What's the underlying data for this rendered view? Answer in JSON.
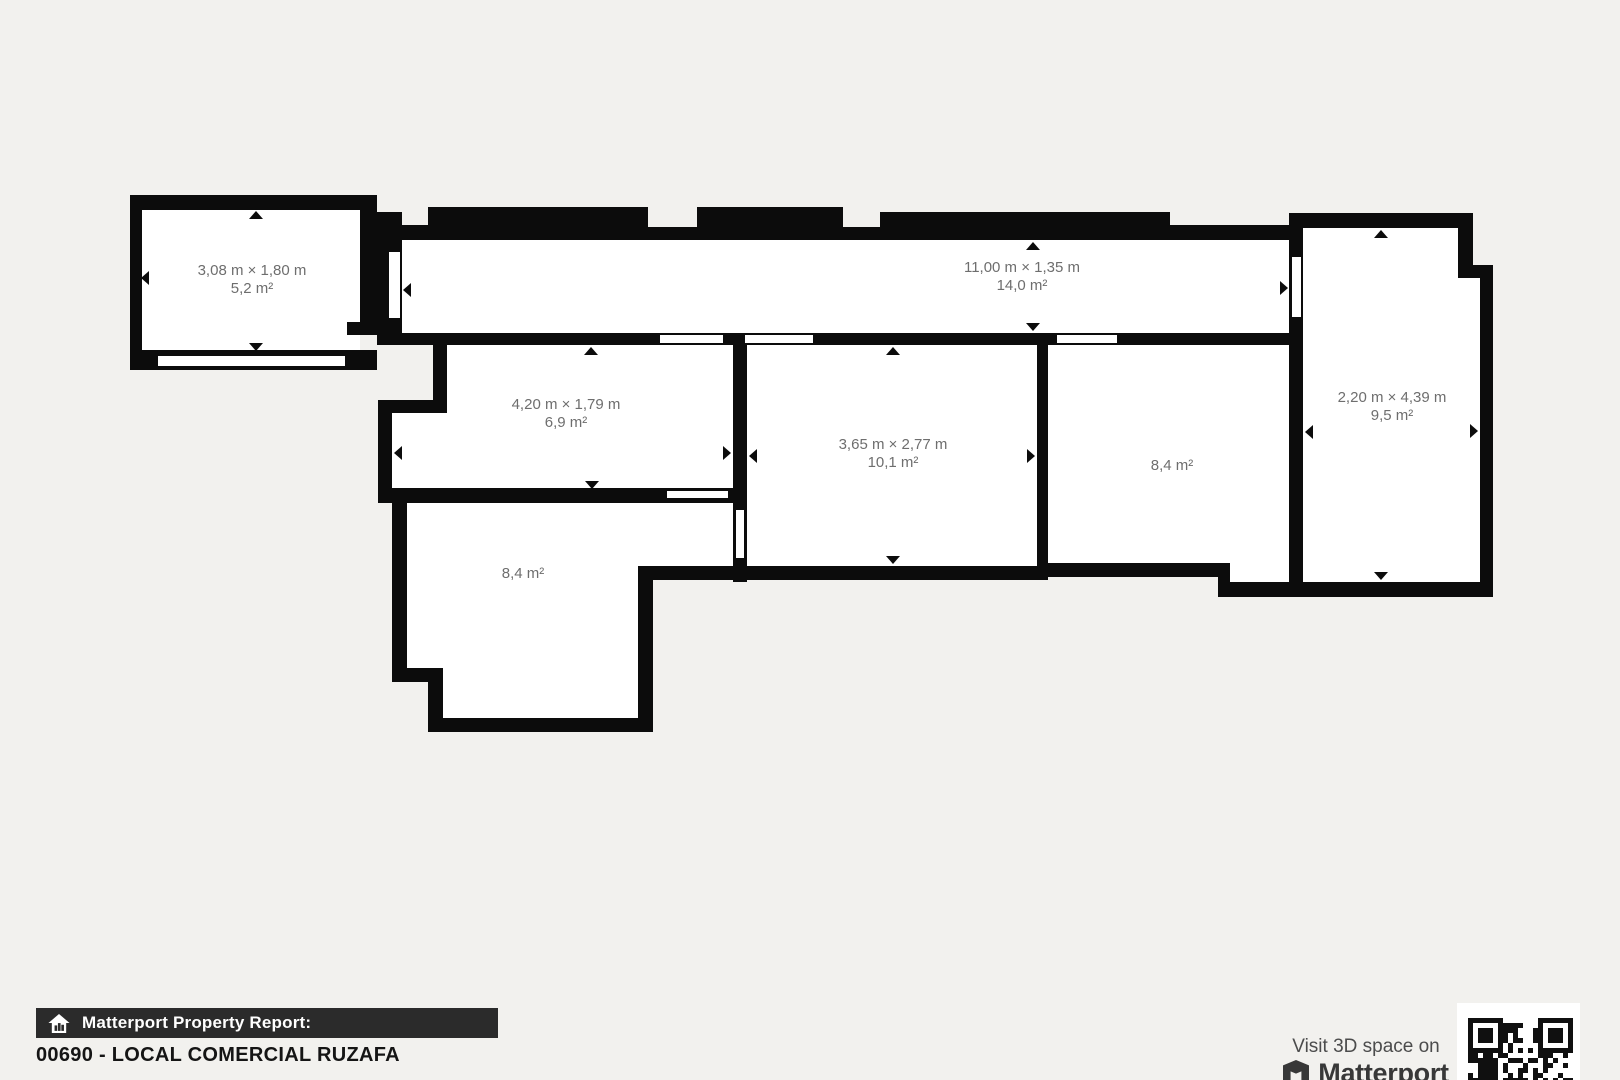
{
  "colors": {
    "background": "#f2f1ee",
    "wall": "#0c0c0c",
    "room": "#ffffff",
    "label": "#6e6e6e",
    "footer_bar": "#2b2b2b",
    "footer_bar_text": "#ffffff",
    "title_text": "#151515",
    "visit_text": "#4c4c4c",
    "brand_text": "#383838",
    "qr_dark": "#101010"
  },
  "rooms": [
    {
      "name": "room-top-left",
      "dimensions": "3,08 m × 1,80 m",
      "area": "5,2 m²"
    },
    {
      "name": "corridor",
      "dimensions": "11,00 m × 1,35 m",
      "area": "14,0 m²"
    },
    {
      "name": "room-420",
      "dimensions": "4,20 m × 1,79 m",
      "area": "6,9 m²"
    },
    {
      "name": "room-365",
      "dimensions": "3,65 m × 2,77 m",
      "area": "10,1 m²"
    },
    {
      "name": "room-right-84",
      "area": "8,4 m²"
    },
    {
      "name": "room-bottom-84",
      "area": "8,4 m²"
    },
    {
      "name": "room-right",
      "dimensions": "2,20 m × 4,39 m",
      "area": "9,5 m²"
    }
  ],
  "footer": {
    "report_label": "Matterport Property Report:",
    "property_title": "00690 - LOCAL COMERCIAL RUZAFA",
    "visit_text": "Visit 3D space on",
    "brand": "Matterport"
  }
}
